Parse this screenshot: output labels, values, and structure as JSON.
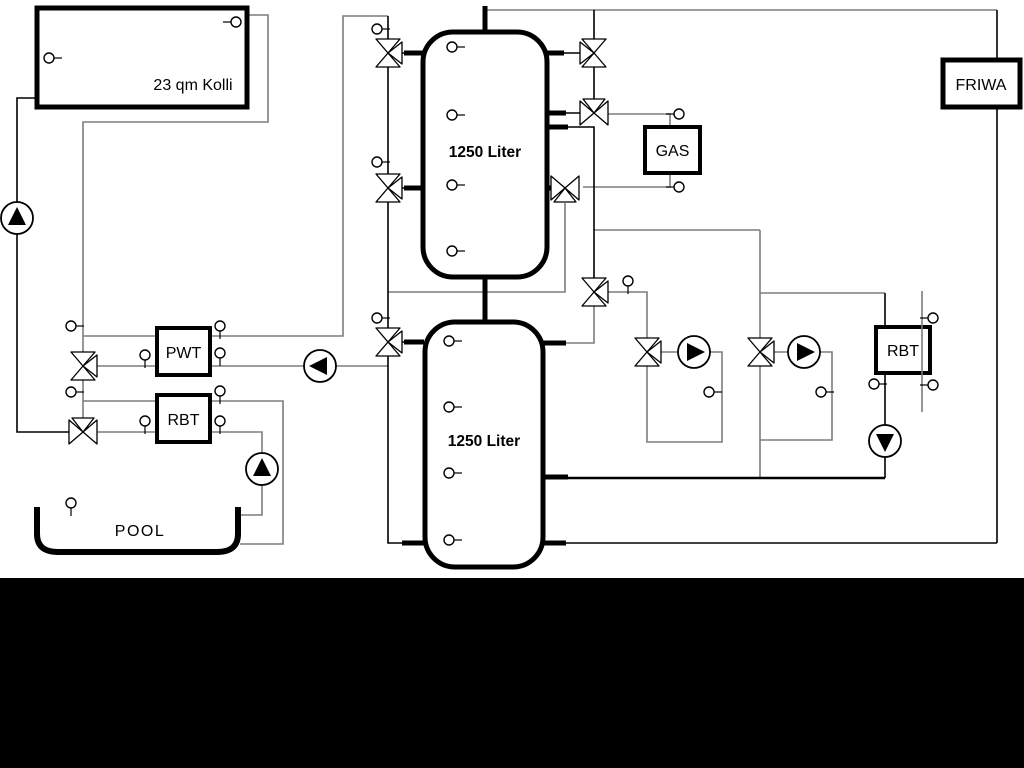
{
  "schematic": {
    "solar_collector_label": "23 qm Kolli",
    "tank_top_label": "1250 Liter",
    "tank_bottom_label": "1250 Liter",
    "pwt_label": "PWT",
    "rbt_left_label": "RBT",
    "rbt_right_label": "RBT",
    "pool_label": "POOL",
    "gas_label": "GAS",
    "friwa_label": "FRIWA"
  },
  "colors": {
    "pipe_gray": "#7d7d7d",
    "pipe_black": "#000000",
    "background": "#ffffff",
    "letterbox": "#000000"
  }
}
